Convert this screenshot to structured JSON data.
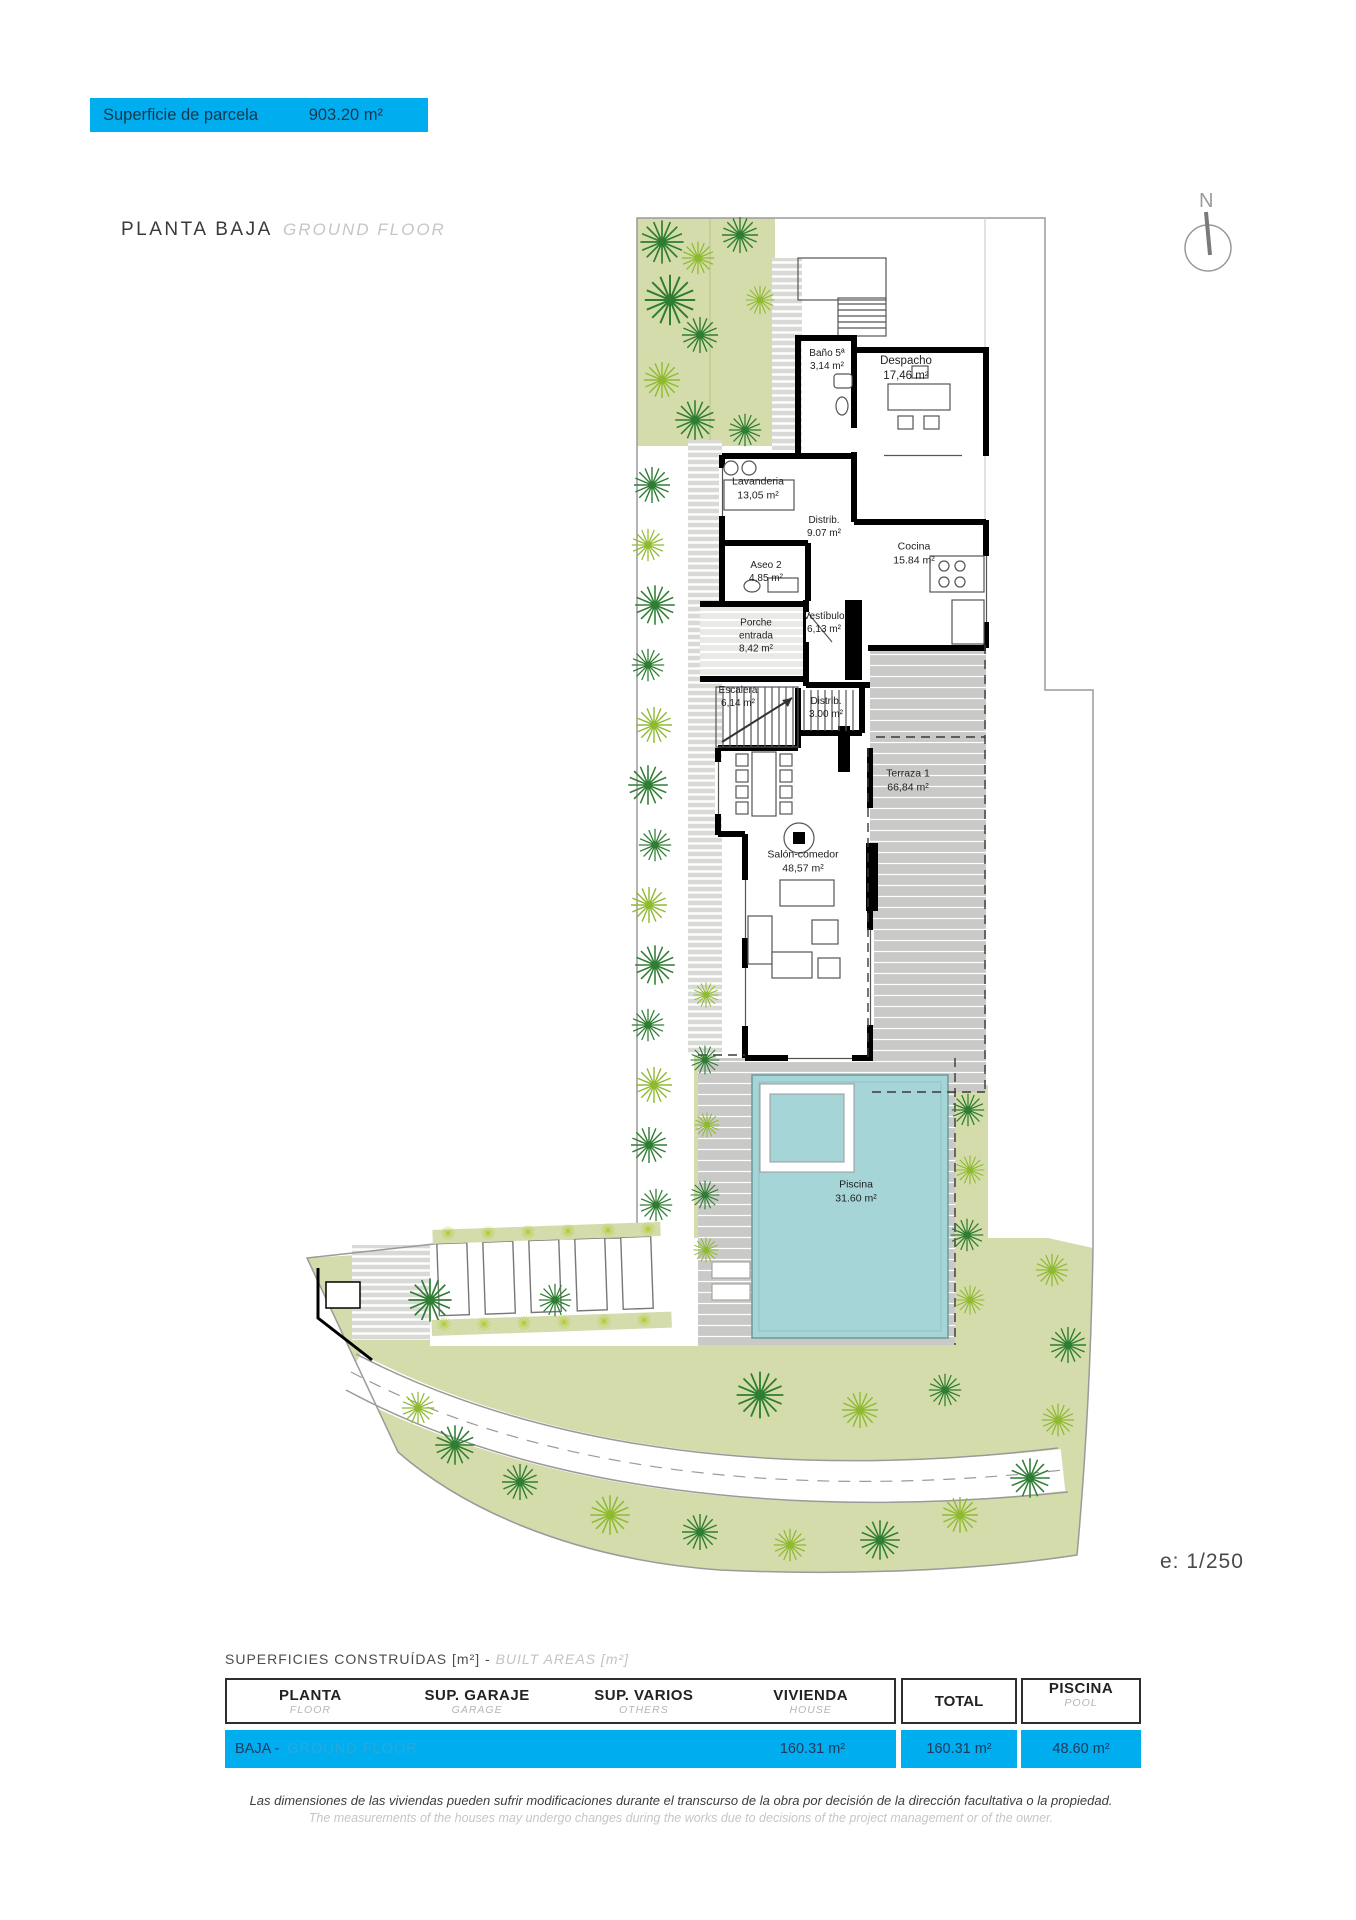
{
  "banner": {
    "label": "Superficie de parcela",
    "value": "903.20 m²"
  },
  "title": {
    "es": "PLANTA BAJA",
    "en": "GROUND FLOOR"
  },
  "north_label": "N",
  "scale_label": "e: 1/250",
  "rooms": [
    {
      "name": "Baño 5ª",
      "area": "3,14 m²"
    },
    {
      "name": "Despacho",
      "area": "17,46 m²"
    },
    {
      "name": "Lavanderia",
      "area": "13,05 m²"
    },
    {
      "name": "Distrib.",
      "area": "9.07 m²"
    },
    {
      "name": "Cocina",
      "area": "15.84 m²"
    },
    {
      "name": "Aseo 2",
      "area": "4,85 m²"
    },
    {
      "name": "Porche entrada",
      "area": "8,42 m²"
    },
    {
      "name": "Vestíbulo",
      "area": "6,13 m²"
    },
    {
      "name": "Escalera",
      "area": "6,14 m²"
    },
    {
      "name": "Distrib.",
      "area": "3.00 m²"
    },
    {
      "name": "Terraza 1",
      "area": "66,84 m²"
    },
    {
      "name": "Salón-comedor",
      "area": "48,57 m²"
    },
    {
      "name": "Piscina",
      "area": "31.60 m²"
    }
  ],
  "areas_table": {
    "heading_es": "SUPERFICIES CONSTRUÍDAS [m²] -",
    "heading_en": "BUILT AREAS [m²]",
    "columns": [
      {
        "es": "PLANTA",
        "en": "FLOOR"
      },
      {
        "es": "SUP. GARAJE",
        "en": "GARAGE"
      },
      {
        "es": "SUP. VARIOS",
        "en": "OTHERS"
      },
      {
        "es": "VIVIENDA",
        "en": "HOUSE"
      },
      {
        "es": "TOTAL",
        "en": ""
      },
      {
        "es": "PISCINA",
        "en": "POOL"
      }
    ],
    "row": {
      "floor_es": "BAJA -",
      "floor_en": "GROUND FLOOR",
      "house": "160.31 m²",
      "total": "160.31 m²",
      "pool": "48.60 m²"
    }
  },
  "disclaimer": {
    "es": "Las dimensiones de las viviendas pueden sufrir modificaciones durante el transcurso de la obra por decisión de la dirección facultativa o la propiedad.",
    "en": "The measurements of the houses may undergo changes during the works due to decisions of the project management or of the owner."
  },
  "colors": {
    "accent_cyan": "#00aeef",
    "pool": "#a5d5d7",
    "garden": "#d4dcab",
    "terrace": "#c9c9c7",
    "tree_dark": "#2e7d32",
    "tree_light": "#8fba30"
  }
}
